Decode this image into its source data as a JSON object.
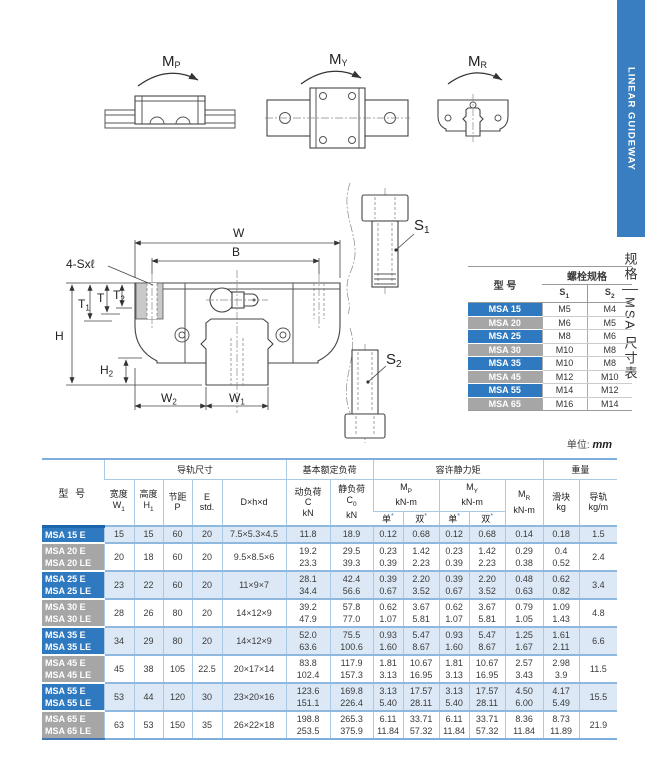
{
  "colors": {
    "accent_blue": "#2e79c0",
    "label_gray": "#a6a6a6",
    "band_blue": "#dce8f5",
    "separator_blue": "#8fb8de",
    "banner_blue": "#3a7ec2"
  },
  "banner": {
    "text": "LINEAR GUIDEWAY"
  },
  "side_tab": {
    "top": "规格",
    "bottom": "MSA 尺寸表"
  },
  "moments": {
    "mp": {
      "base": "M",
      "sub": "P"
    },
    "my": {
      "base": "M",
      "sub": "Y"
    },
    "mr": {
      "base": "M",
      "sub": "R"
    }
  },
  "drawing": {
    "screws_label": "4-Sxℓ",
    "dim_w": "W",
    "dim_b": "B",
    "dim_h": "H",
    "dim_t": "T",
    "dim_t1": {
      "base": "T",
      "sub": "1"
    },
    "dim_t2": {
      "base": "T",
      "sub": "2"
    },
    "dim_h2": {
      "base": "H",
      "sub": "2"
    },
    "dim_w2": {
      "base": "W",
      "sub": "2"
    },
    "dim_w1": {
      "base": "W",
      "sub": "1"
    },
    "bolt_s1": {
      "base": "S",
      "sub": "1"
    },
    "bolt_s2": {
      "base": "S",
      "sub": "2"
    }
  },
  "bolt_table": {
    "header": {
      "model": "型 号",
      "group": "螺栓规格",
      "s1": {
        "base": "S",
        "sub": "1"
      },
      "s2": {
        "base": "S",
        "sub": "2"
      }
    },
    "rows": [
      {
        "model": "MSA 15",
        "s1": "M5",
        "s2": "M4"
      },
      {
        "model": "MSA 20",
        "s1": "M6",
        "s2": "M5"
      },
      {
        "model": "MSA 25",
        "s1": "M8",
        "s2": "M6"
      },
      {
        "model": "MSA 30",
        "s1": "M10",
        "s2": "M8"
      },
      {
        "model": "MSA 35",
        "s1": "M10",
        "s2": "M8"
      },
      {
        "model": "MSA 45",
        "s1": "M12",
        "s2": "M10"
      },
      {
        "model": "MSA 55",
        "s1": "M14",
        "s2": "M12"
      },
      {
        "model": "MSA 65",
        "s1": "M16",
        "s2": "M14"
      }
    ]
  },
  "unit_note": {
    "label": "单位:",
    "value": "mm"
  },
  "main_table": {
    "header": {
      "model": "型 号",
      "rail_dims": "导轨尺寸",
      "rated_load": "基本额定负荷",
      "static_moment": "容许静力矩",
      "weight": "重量",
      "width_l": "宽度",
      "width_s": {
        "base": "W",
        "sub": "1"
      },
      "height_l": "高度",
      "height_s": {
        "base": "H",
        "sub": "1"
      },
      "pitch_l": "节距",
      "pitch_s": "P",
      "e_l": "E",
      "e_s": "std.",
      "dhd": "D×h×d",
      "dyn_l": "动负荷",
      "dyn_s": "C",
      "dyn_u": "kN",
      "stat_l": "静负荷",
      "stat_s": {
        "base": "C",
        "sub": "0"
      },
      "stat_u": "kN",
      "mp": {
        "base": "M",
        "sub": "P"
      },
      "my": {
        "base": "M",
        "sub": "Y"
      },
      "mr": {
        "base": "M",
        "sub": "R"
      },
      "knm": "kN-m",
      "single": "单",
      "double": "双",
      "star": "*",
      "slider_l": "滑块",
      "slider_u": "kg",
      "rail_l": "导轨",
      "rail_u": "kg/m"
    },
    "rows": [
      {
        "models": [
          "MSA 15 E"
        ],
        "w1": "15",
        "h1": "15",
        "p": "60",
        "e": "20",
        "dhd": "7.5×5.3×4.5",
        "c": [
          "11.8"
        ],
        "c0": [
          "18.9"
        ],
        "mp_single": [
          "0.12"
        ],
        "mp_double": [
          "0.68"
        ],
        "my_single": [
          "0.12"
        ],
        "my_double": [
          "0.68"
        ],
        "mr": [
          "0.14"
        ],
        "slider_kg": [
          "0.18"
        ],
        "rail_kgm": "1.5"
      },
      {
        "models": [
          "MSA 20 E",
          "MSA 20 LE"
        ],
        "w1": "20",
        "h1": "18",
        "p": "60",
        "e": "20",
        "dhd": "9.5×8.5×6",
        "c": [
          "19.2",
          "23.3"
        ],
        "c0": [
          "29.5",
          "39.3"
        ],
        "mp_single": [
          "0.23",
          "0.39"
        ],
        "mp_double": [
          "1.42",
          "2.23"
        ],
        "my_single": [
          "0.23",
          "0.39"
        ],
        "my_double": [
          "1.42",
          "2.23"
        ],
        "mr": [
          "0.29",
          "0.38"
        ],
        "slider_kg": [
          "0.4",
          "0.52"
        ],
        "rail_kgm": "2.4"
      },
      {
        "models": [
          "MSA 25 E",
          "MSA 25 LE"
        ],
        "w1": "23",
        "h1": "22",
        "p": "60",
        "e": "20",
        "dhd": "11×9×7",
        "c": [
          "28.1",
          "34.4"
        ],
        "c0": [
          "42.4",
          "56.6"
        ],
        "mp_single": [
          "0.39",
          "0.67"
        ],
        "mp_double": [
          "2.20",
          "3.52"
        ],
        "my_single": [
          "0.39",
          "0.67"
        ],
        "my_double": [
          "2.20",
          "3.52"
        ],
        "mr": [
          "0.48",
          "0.63"
        ],
        "slider_kg": [
          "0.62",
          "0.82"
        ],
        "rail_kgm": "3.4"
      },
      {
        "models": [
          "MSA 30 E",
          "MSA 30 LE"
        ],
        "w1": "28",
        "h1": "26",
        "p": "80",
        "e": "20",
        "dhd": "14×12×9",
        "c": [
          "39.2",
          "47.9"
        ],
        "c0": [
          "57.8",
          "77.0"
        ],
        "mp_single": [
          "0.62",
          "1.07"
        ],
        "mp_double": [
          "3.67",
          "5.81"
        ],
        "my_single": [
          "0.62",
          "1.07"
        ],
        "my_double": [
          "3.67",
          "5.81"
        ],
        "mr": [
          "0.79",
          "1.05"
        ],
        "slider_kg": [
          "1.09",
          "1.43"
        ],
        "rail_kgm": "4.8"
      },
      {
        "models": [
          "MSA 35 E",
          "MSA 35 LE"
        ],
        "w1": "34",
        "h1": "29",
        "p": "80",
        "e": "20",
        "dhd": "14×12×9",
        "c": [
          "52.0",
          "63.6"
        ],
        "c0": [
          "75.5",
          "100.6"
        ],
        "mp_single": [
          "0.93",
          "1.60"
        ],
        "mp_double": [
          "5.47",
          "8.67"
        ],
        "my_single": [
          "0.93",
          "1.60"
        ],
        "my_double": [
          "5.47",
          "8.67"
        ],
        "mr": [
          "1.25",
          "1.67"
        ],
        "slider_kg": [
          "1.61",
          "2.11"
        ],
        "rail_kgm": "6.6"
      },
      {
        "models": [
          "MSA 45 E",
          "MSA 45 LE"
        ],
        "w1": "45",
        "h1": "38",
        "p": "105",
        "e": "22.5",
        "dhd": "20×17×14",
        "c": [
          "83.8",
          "102.4"
        ],
        "c0": [
          "117.9",
          "157.3"
        ],
        "mp_single": [
          "1.81",
          "3.13"
        ],
        "mp_double": [
          "10.67",
          "16.95"
        ],
        "my_single": [
          "1.81",
          "3.13"
        ],
        "my_double": [
          "10.67",
          "16.95"
        ],
        "mr": [
          "2.57",
          "3.43"
        ],
        "slider_kg": [
          "2.98",
          "3.9"
        ],
        "rail_kgm": "11.5"
      },
      {
        "models": [
          "MSA 55 E",
          "MSA 55 LE"
        ],
        "w1": "53",
        "h1": "44",
        "p": "120",
        "e": "30",
        "dhd": "23×20×16",
        "c": [
          "123.6",
          "151.1"
        ],
        "c0": [
          "169.8",
          "226.4"
        ],
        "mp_single": [
          "3.13",
          "5.40"
        ],
        "mp_double": [
          "17.57",
          "28.11"
        ],
        "my_single": [
          "3.13",
          "5.40"
        ],
        "my_double": [
          "17.57",
          "28.11"
        ],
        "mr": [
          "4.50",
          "6.00"
        ],
        "slider_kg": [
          "4.17",
          "5.49"
        ],
        "rail_kgm": "15.5"
      },
      {
        "models": [
          "MSA 65 E",
          "MSA 65 LE"
        ],
        "w1": "63",
        "h1": "53",
        "p": "150",
        "e": "35",
        "dhd": "26×22×18",
        "c": [
          "198.8",
          "253.5"
        ],
        "c0": [
          "265.3",
          "375.9"
        ],
        "mp_single": [
          "6.11",
          "11.84"
        ],
        "mp_double": [
          "33.71",
          "57.32"
        ],
        "my_single": [
          "6.11",
          "11.84"
        ],
        "my_double": [
          "33.71",
          "57.32"
        ],
        "mr": [
          "8.36",
          "11.84"
        ],
        "slider_kg": [
          "8.73",
          "11.89"
        ],
        "rail_kgm": "21.9"
      }
    ]
  }
}
